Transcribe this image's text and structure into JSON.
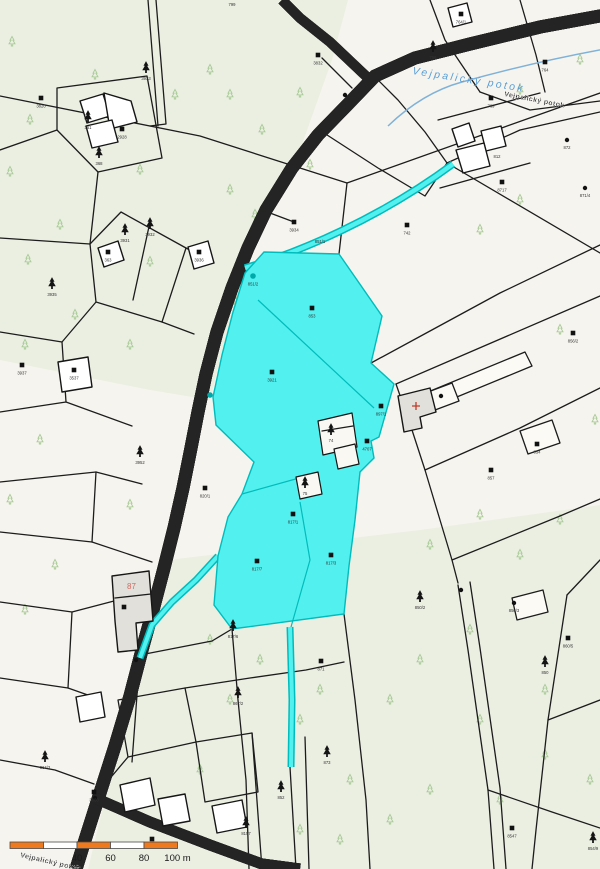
{
  "map": {
    "stream_label": {
      "text": "Vejpalický potok",
      "color": "#5b9ed6"
    },
    "hatched_labels": [
      {
        "text": "Vejpalický potok",
        "x": 504,
        "y": 96,
        "rot": 11
      },
      {
        "text": "Vejpalický potok",
        "x": 20,
        "y": 857,
        "rot": 13
      }
    ],
    "house_number": {
      "text": "87",
      "x": 127,
      "y": 589,
      "color": "#cf6a62"
    },
    "colors": {
      "background": "#f6f4ee",
      "forest": "#ebefe2",
      "boundary": "#1c1c1c",
      "highlight_fill": "#52f0ee",
      "highlight_border": "#00bcbc",
      "road_fill": "#f3f2ec",
      "stream": "#7fb2d9",
      "light_tree": "#a9cb97",
      "building_grey": "#e2e0da",
      "red_accent": "#c0392b",
      "scalebar_orange": "#ee7a1d"
    },
    "markers": {
      "squares": [
        [
          41,
          98,
          "3820"
        ],
        [
          122,
          129,
          "2928"
        ],
        [
          318,
          55,
          "3832"
        ],
        [
          294,
          222,
          "3934"
        ],
        [
          108,
          252,
          "363"
        ],
        [
          22,
          365,
          "3937"
        ],
        [
          74,
          370,
          "3537"
        ],
        [
          205,
          488,
          "820/1"
        ],
        [
          312,
          308,
          "853"
        ],
        [
          272,
          372,
          "3921"
        ],
        [
          381,
          406,
          "897/1"
        ],
        [
          367,
          441,
          "4707"
        ],
        [
          407,
          225,
          "742"
        ],
        [
          545,
          62,
          "764"
        ],
        [
          491,
          98,
          "769"
        ],
        [
          502,
          182,
          "8717"
        ],
        [
          573,
          333,
          "856/2"
        ],
        [
          537,
          444,
          "854"
        ],
        [
          491,
          470,
          "857"
        ],
        [
          568,
          638,
          "860/5"
        ],
        [
          512,
          828,
          "8547"
        ],
        [
          152,
          839,
          "8152"
        ],
        [
          94,
          792,
          "3860"
        ],
        [
          257,
          561,
          "817/7"
        ],
        [
          331,
          555,
          "817/3"
        ],
        [
          321,
          661,
          "871"
        ],
        [
          293,
          514,
          "817/1"
        ],
        [
          199,
          252,
          "3936"
        ],
        [
          461,
          14,
          "764/1"
        ],
        [
          124,
          607,
          ""
        ]
      ],
      "conifers": [
        [
          146,
          68,
          "3933"
        ],
        [
          88,
          117,
          "361"
        ],
        [
          99,
          153,
          "368"
        ],
        [
          125,
          230,
          "3931"
        ],
        [
          150,
          224,
          "3932"
        ],
        [
          52,
          284,
          "3935"
        ],
        [
          140,
          452,
          "3952"
        ],
        [
          331,
          430,
          "74"
        ],
        [
          305,
          483,
          "75"
        ],
        [
          233,
          626,
          "817/6"
        ],
        [
          238,
          693,
          "867/2"
        ],
        [
          327,
          752,
          "873"
        ],
        [
          281,
          787,
          "852"
        ],
        [
          45,
          757,
          "864/3"
        ],
        [
          246,
          823,
          "8157"
        ],
        [
          420,
          597,
          "850/2"
        ],
        [
          545,
          662,
          "850"
        ],
        [
          593,
          838,
          "854/9"
        ],
        [
          433,
          47,
          "756"
        ]
      ],
      "dots": [
        [
          345,
          95,
          ""
        ],
        [
          136,
          660,
          ""
        ],
        [
          441,
          396,
          ""
        ],
        [
          461,
          590,
          ""
        ],
        [
          514,
          603,
          "850/3"
        ],
        [
          567,
          140,
          "872"
        ],
        [
          585,
          188,
          "871/4"
        ],
        [
          95,
          798,
          ""
        ]
      ],
      "teal_dots": [
        [
          253,
          276,
          "851/2"
        ],
        [
          210,
          395,
          ""
        ]
      ]
    },
    "parcel_labels": [
      [
        497,
        158,
        "812"
      ],
      [
        232,
        6,
        "799"
      ],
      [
        320,
        243,
        "851/1"
      ]
    ],
    "light_trees": [
      [
        12,
        42
      ],
      [
        95,
        75
      ],
      [
        175,
        95
      ],
      [
        210,
        70
      ],
      [
        30,
        120
      ],
      [
        140,
        170
      ],
      [
        10,
        172
      ],
      [
        60,
        225
      ],
      [
        28,
        260
      ],
      [
        150,
        262
      ],
      [
        75,
        315
      ],
      [
        25,
        345
      ],
      [
        130,
        345
      ],
      [
        40,
        440
      ],
      [
        10,
        500
      ],
      [
        130,
        505
      ],
      [
        55,
        565
      ],
      [
        25,
        610
      ],
      [
        230,
        95
      ],
      [
        262,
        130
      ],
      [
        300,
        93
      ],
      [
        230,
        190
      ],
      [
        255,
        215
      ],
      [
        310,
        165
      ],
      [
        520,
        200
      ],
      [
        480,
        230
      ],
      [
        560,
        330
      ],
      [
        595,
        420
      ],
      [
        480,
        515
      ],
      [
        560,
        520
      ],
      [
        430,
        545
      ],
      [
        520,
        555
      ],
      [
        470,
        630
      ],
      [
        545,
        690
      ],
      [
        420,
        660
      ],
      [
        390,
        700
      ],
      [
        480,
        720
      ],
      [
        545,
        755
      ],
      [
        590,
        780
      ],
      [
        430,
        790
      ],
      [
        500,
        800
      ],
      [
        390,
        820
      ],
      [
        350,
        780
      ],
      [
        320,
        690
      ],
      [
        260,
        660
      ],
      [
        300,
        720
      ],
      [
        230,
        700
      ],
      [
        200,
        770
      ],
      [
        340,
        840
      ],
      [
        300,
        830
      ],
      [
        580,
        60
      ],
      [
        520,
        90
      ],
      [
        235,
        300
      ],
      [
        310,
        330
      ],
      [
        290,
        380
      ],
      [
        260,
        430
      ],
      [
        290,
        545
      ],
      [
        240,
        560
      ],
      [
        210,
        640
      ]
    ]
  },
  "scalebar": {
    "x0": 10,
    "y": 842,
    "h": 6.5,
    "seg": 33.5,
    "orange": "#ee7a1d",
    "white": "#ffffff",
    "outline": "#4a4a4a",
    "labels": [
      "40",
      "60",
      "80",
      "100 m"
    ]
  }
}
